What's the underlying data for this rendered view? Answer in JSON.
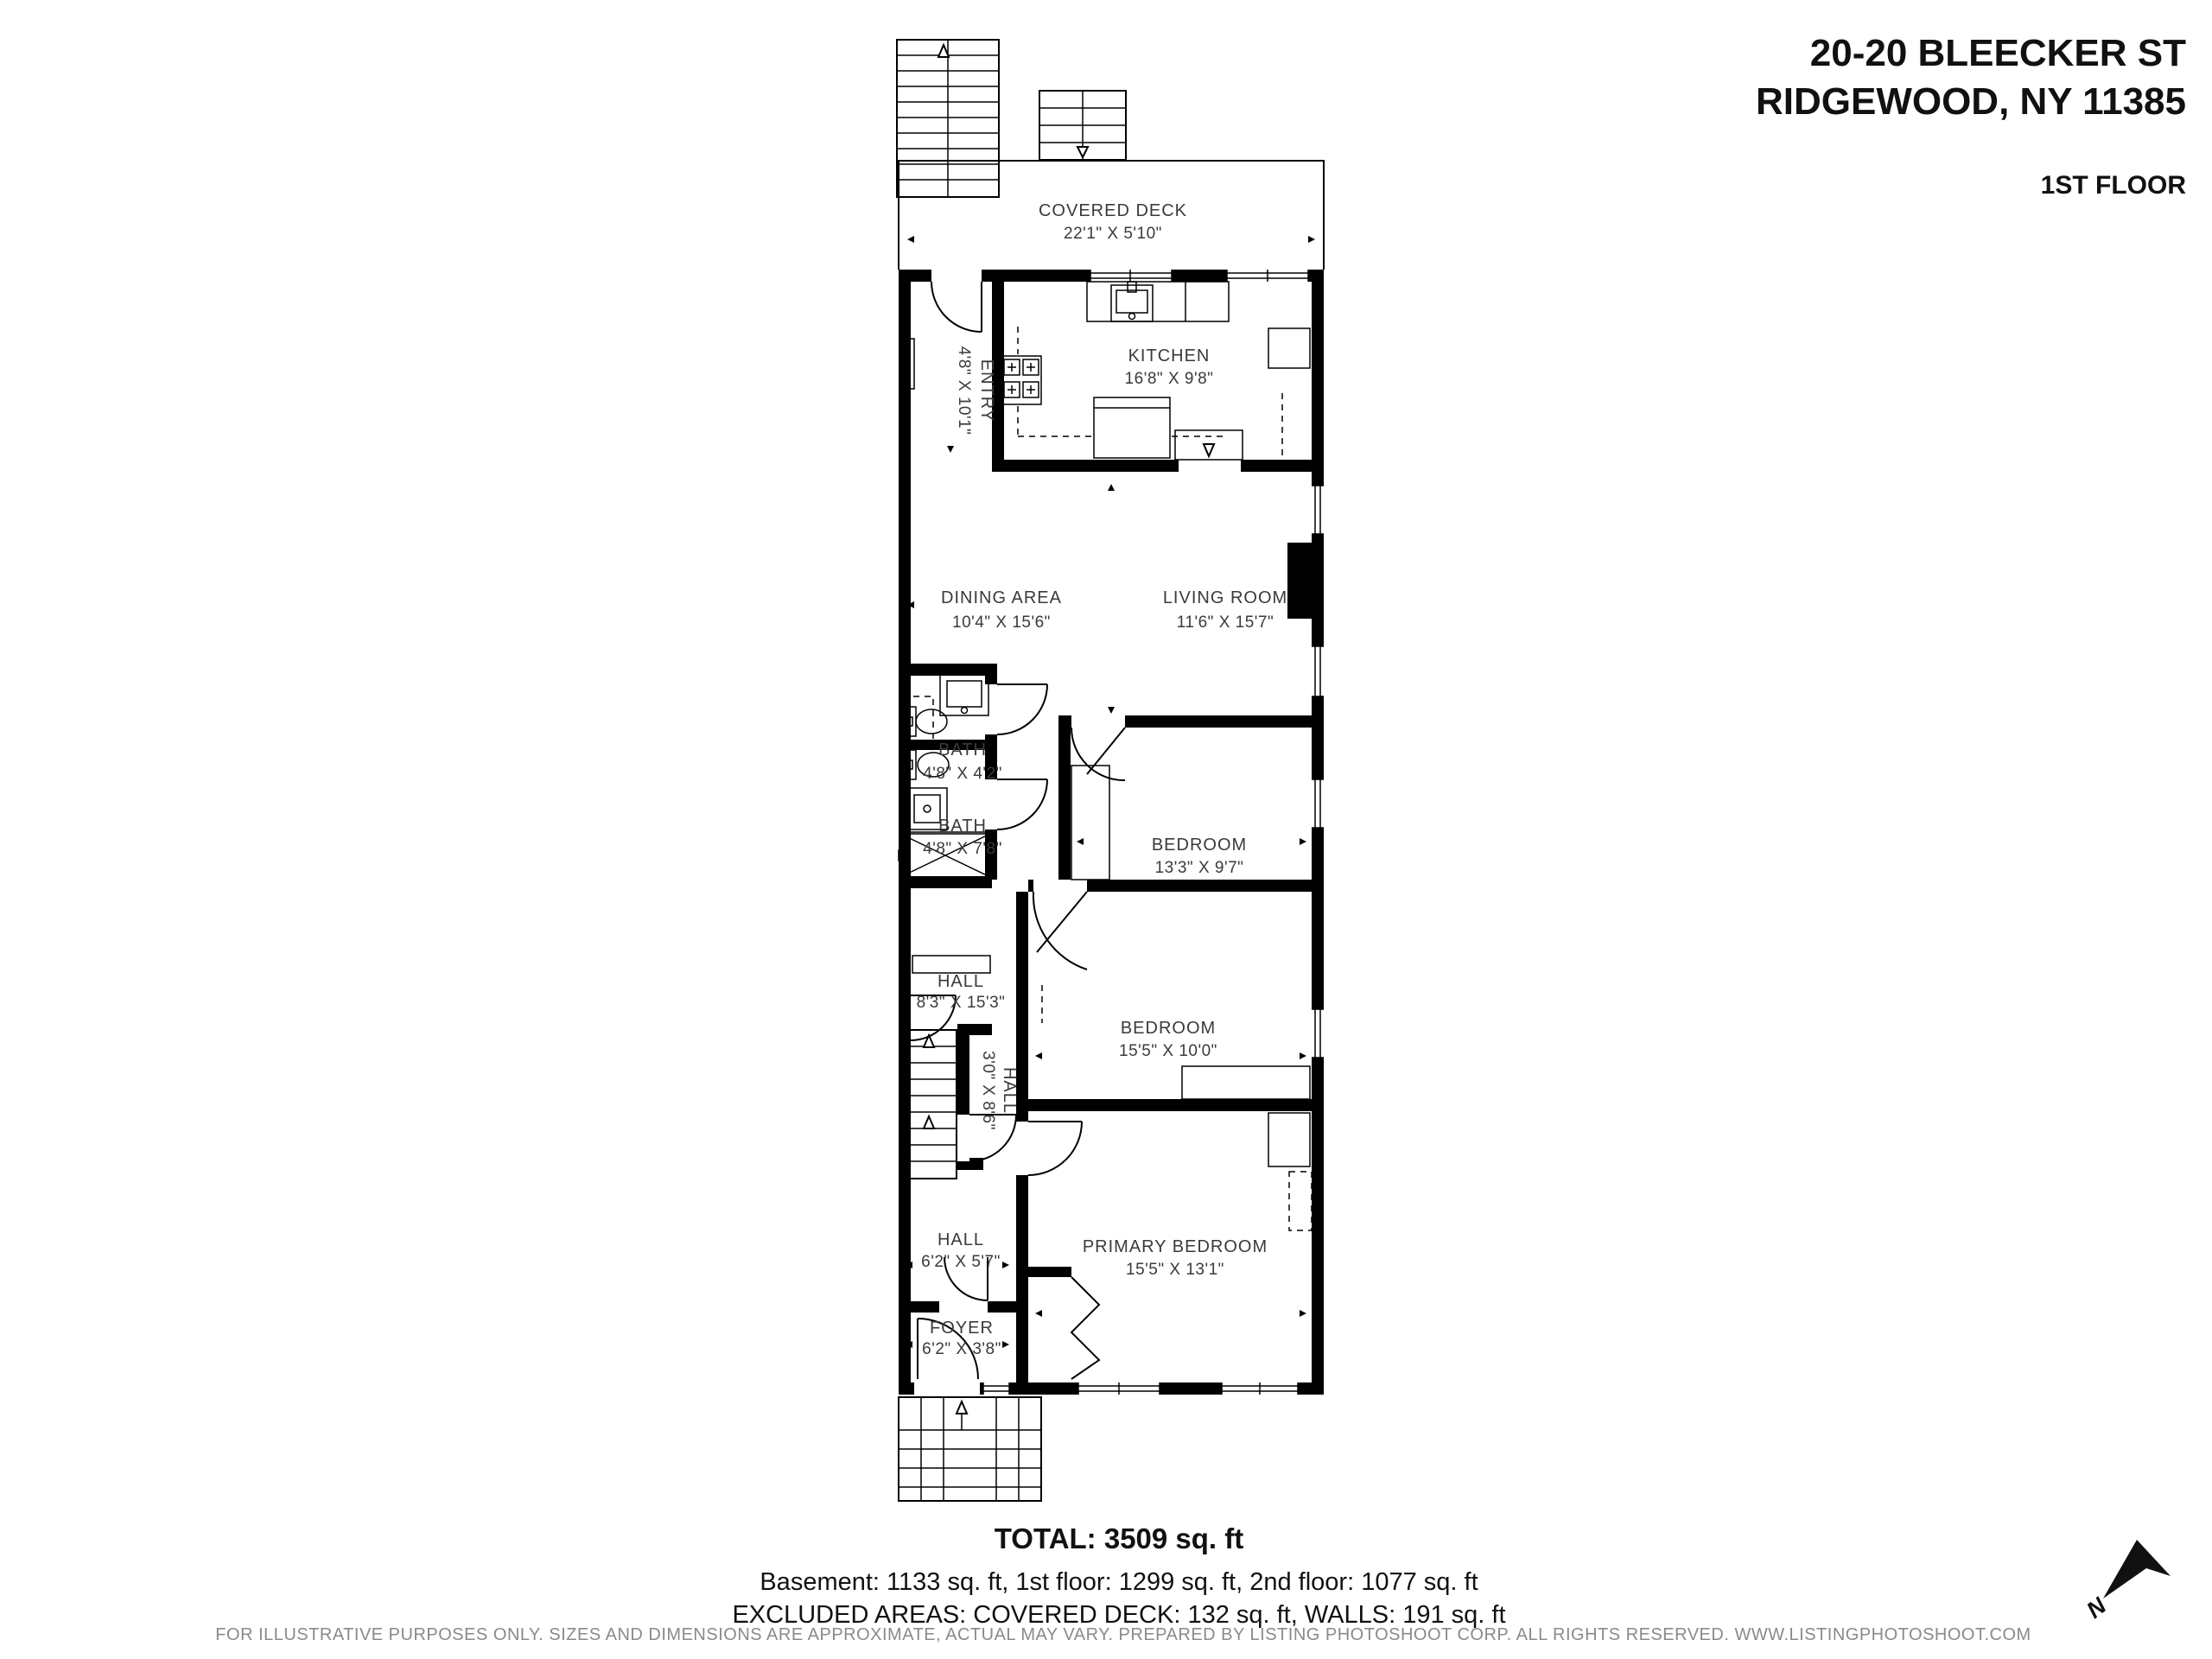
{
  "header": {
    "address_line1": "20-20 BLEECKER ST",
    "address_line2": "RIDGEWOOD, NY 11385",
    "floor_label": "1ST FLOOR"
  },
  "rooms": {
    "covered_deck": {
      "name": "COVERED DECK",
      "dims": "22'1\" X 5'10\""
    },
    "kitchen": {
      "name": "KITCHEN",
      "dims": "16'8\" X 9'8\""
    },
    "entry": {
      "name": "ENTRY",
      "dims": "4'8\" X 10'1\""
    },
    "dining": {
      "name": "DINING AREA",
      "dims": "10'4\" X 15'6\""
    },
    "living": {
      "name": "LIVING ROOM",
      "dims": "11'6\" X 15'7\""
    },
    "bath1": {
      "name": "BATH",
      "dims": "4'8\" X 4'2\""
    },
    "bath2": {
      "name": "BATH",
      "dims": "4'8\" X 7'8\""
    },
    "bedroom1": {
      "name": "BEDROOM",
      "dims": "13'3\" X 9'7\""
    },
    "hall1": {
      "name": "HALL",
      "dims": "8'3\" X 15'3\""
    },
    "bedroom2": {
      "name": "BEDROOM",
      "dims": "15'5\" X 10'0\""
    },
    "hall2": {
      "name": "HALL",
      "dims": "3'0\" X 8'6\""
    },
    "hall3": {
      "name": "HALL",
      "dims": "6'2\" X 5'7\""
    },
    "primary_bedroom": {
      "name": "PRIMARY BEDROOM",
      "dims": "15'5\" X 13'1\""
    },
    "foyer": {
      "name": "FOYER",
      "dims": "6'2\" X 3'8\""
    }
  },
  "footer": {
    "total": "TOTAL: 3509 sq. ft",
    "breakdown": "Basement: 1133 sq. ft, 1st floor: 1299 sq. ft, 2nd floor: 1077 sq. ft",
    "excluded": "EXCLUDED AREAS: COVERED DECK: 132 sq. ft, WALLS: 191 sq. ft",
    "disclaimer": "FOR ILLUSTRATIVE PURPOSES ONLY. SIZES AND DIMENSIONS ARE APPROXIMATE, ACTUAL MAY VARY. PREPARED BY LISTING PHOTOSHOOT CORP. ALL RIGHTS RESERVED. WWW.LISTINGPHOTOSHOOT.COM"
  },
  "compass": {
    "north_label": "N"
  }
}
